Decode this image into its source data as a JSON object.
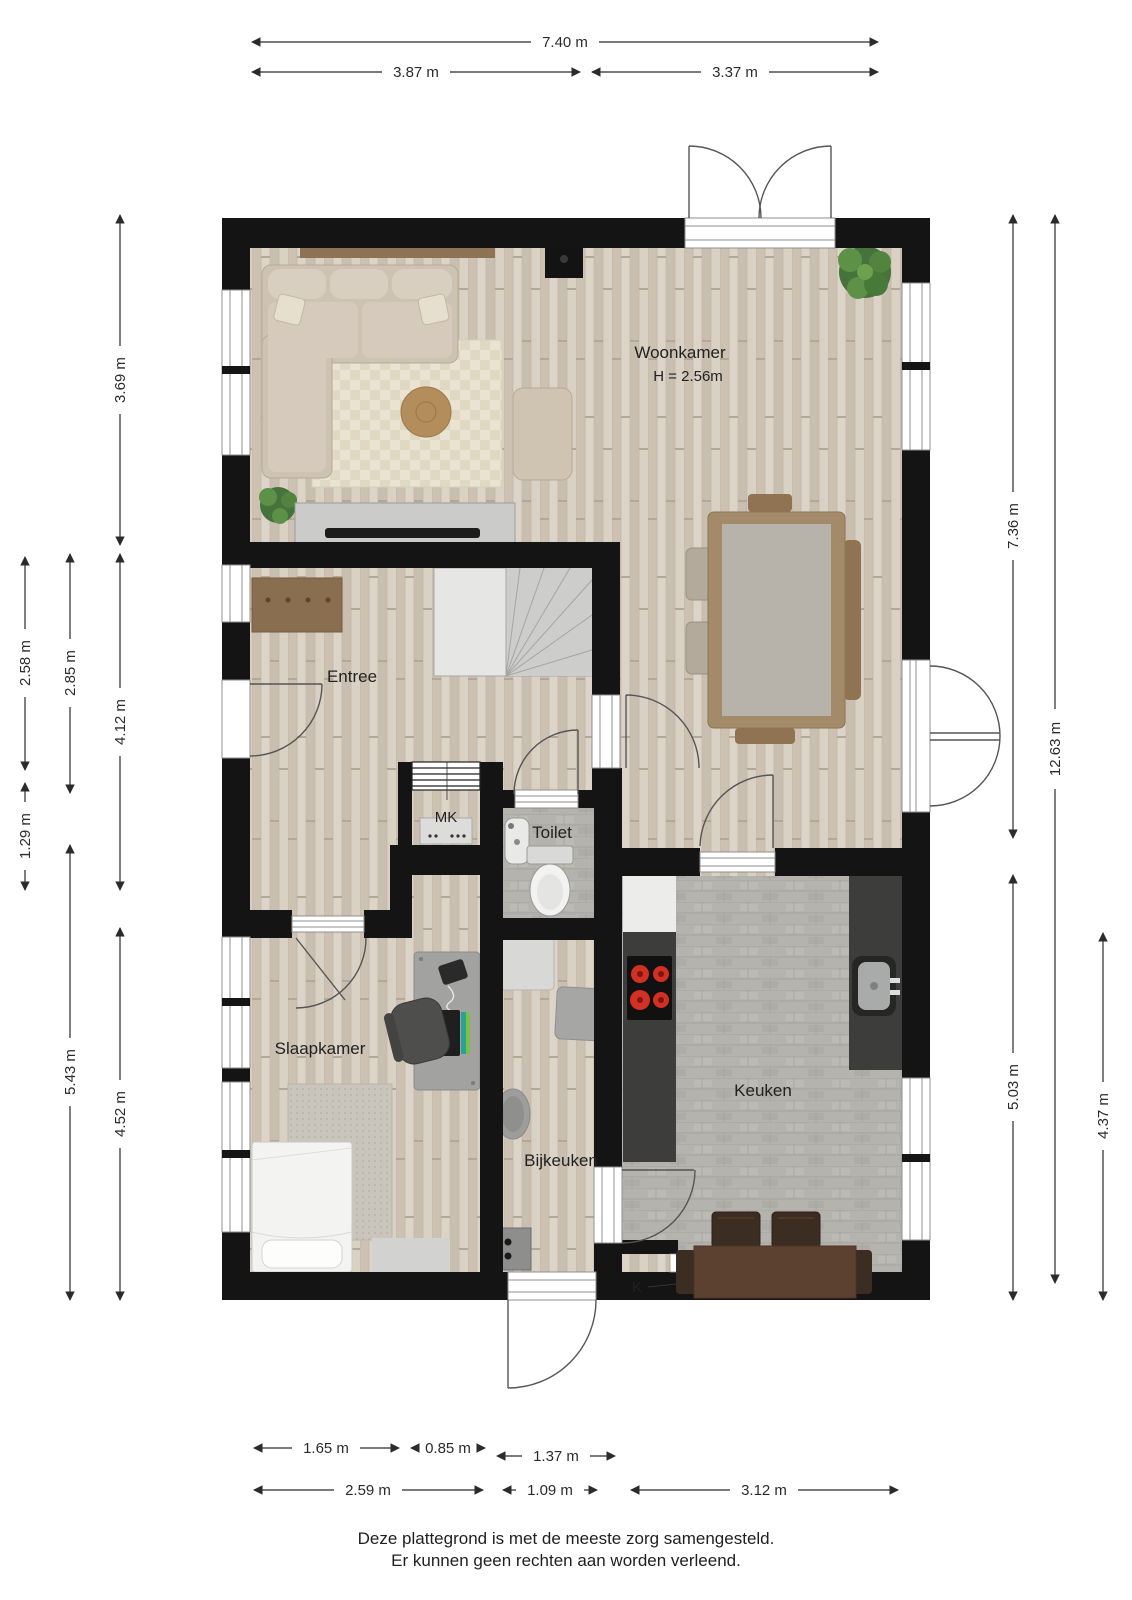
{
  "rooms": {
    "woonkamer": {
      "name": "Woonkamer",
      "height_note": "H = 2.56m"
    },
    "entree": {
      "name": "Entree"
    },
    "mk": {
      "name": "MK"
    },
    "toilet": {
      "name": "Toilet"
    },
    "slaapkamer": {
      "name": "Slaapkamer"
    },
    "bijkeuken": {
      "name": "Bijkeuken"
    },
    "keuken": {
      "name": "Keuken"
    },
    "k": {
      "name": "K"
    }
  },
  "dimensions": {
    "top": [
      {
        "label": "7.40 m"
      },
      {
        "label": "3.87 m"
      },
      {
        "label": "3.37 m"
      }
    ],
    "left": [
      {
        "label": "3.69 m"
      },
      {
        "label": "2.58 m"
      },
      {
        "label": "2.85 m"
      },
      {
        "label": "4.12 m"
      },
      {
        "label": "1.29 m"
      },
      {
        "label": "5.43 m"
      },
      {
        "label": "4.52 m"
      }
    ],
    "right": [
      {
        "label": "7.36 m"
      },
      {
        "label": "12.63 m"
      },
      {
        "label": "5.03 m"
      },
      {
        "label": "4.37 m"
      }
    ],
    "bottom": [
      {
        "label": "1.65 m"
      },
      {
        "label": "0.85 m"
      },
      {
        "label": "1.37 m"
      },
      {
        "label": "2.59 m"
      },
      {
        "label": "1.09 m"
      },
      {
        "label": "3.12 m"
      }
    ]
  },
  "footer": {
    "line1": "Deze plattegrond is met de meeste zorg samengesteld.",
    "line2": "Er kunnen geen rechten aan worden verleend."
  },
  "colors": {
    "wall": "#141414",
    "wood": "#d6cec1",
    "stone": "#b5b3ad",
    "counter": "#3d3d3b",
    "burner": "#d23024",
    "kitchen_table": "#5c4131"
  }
}
